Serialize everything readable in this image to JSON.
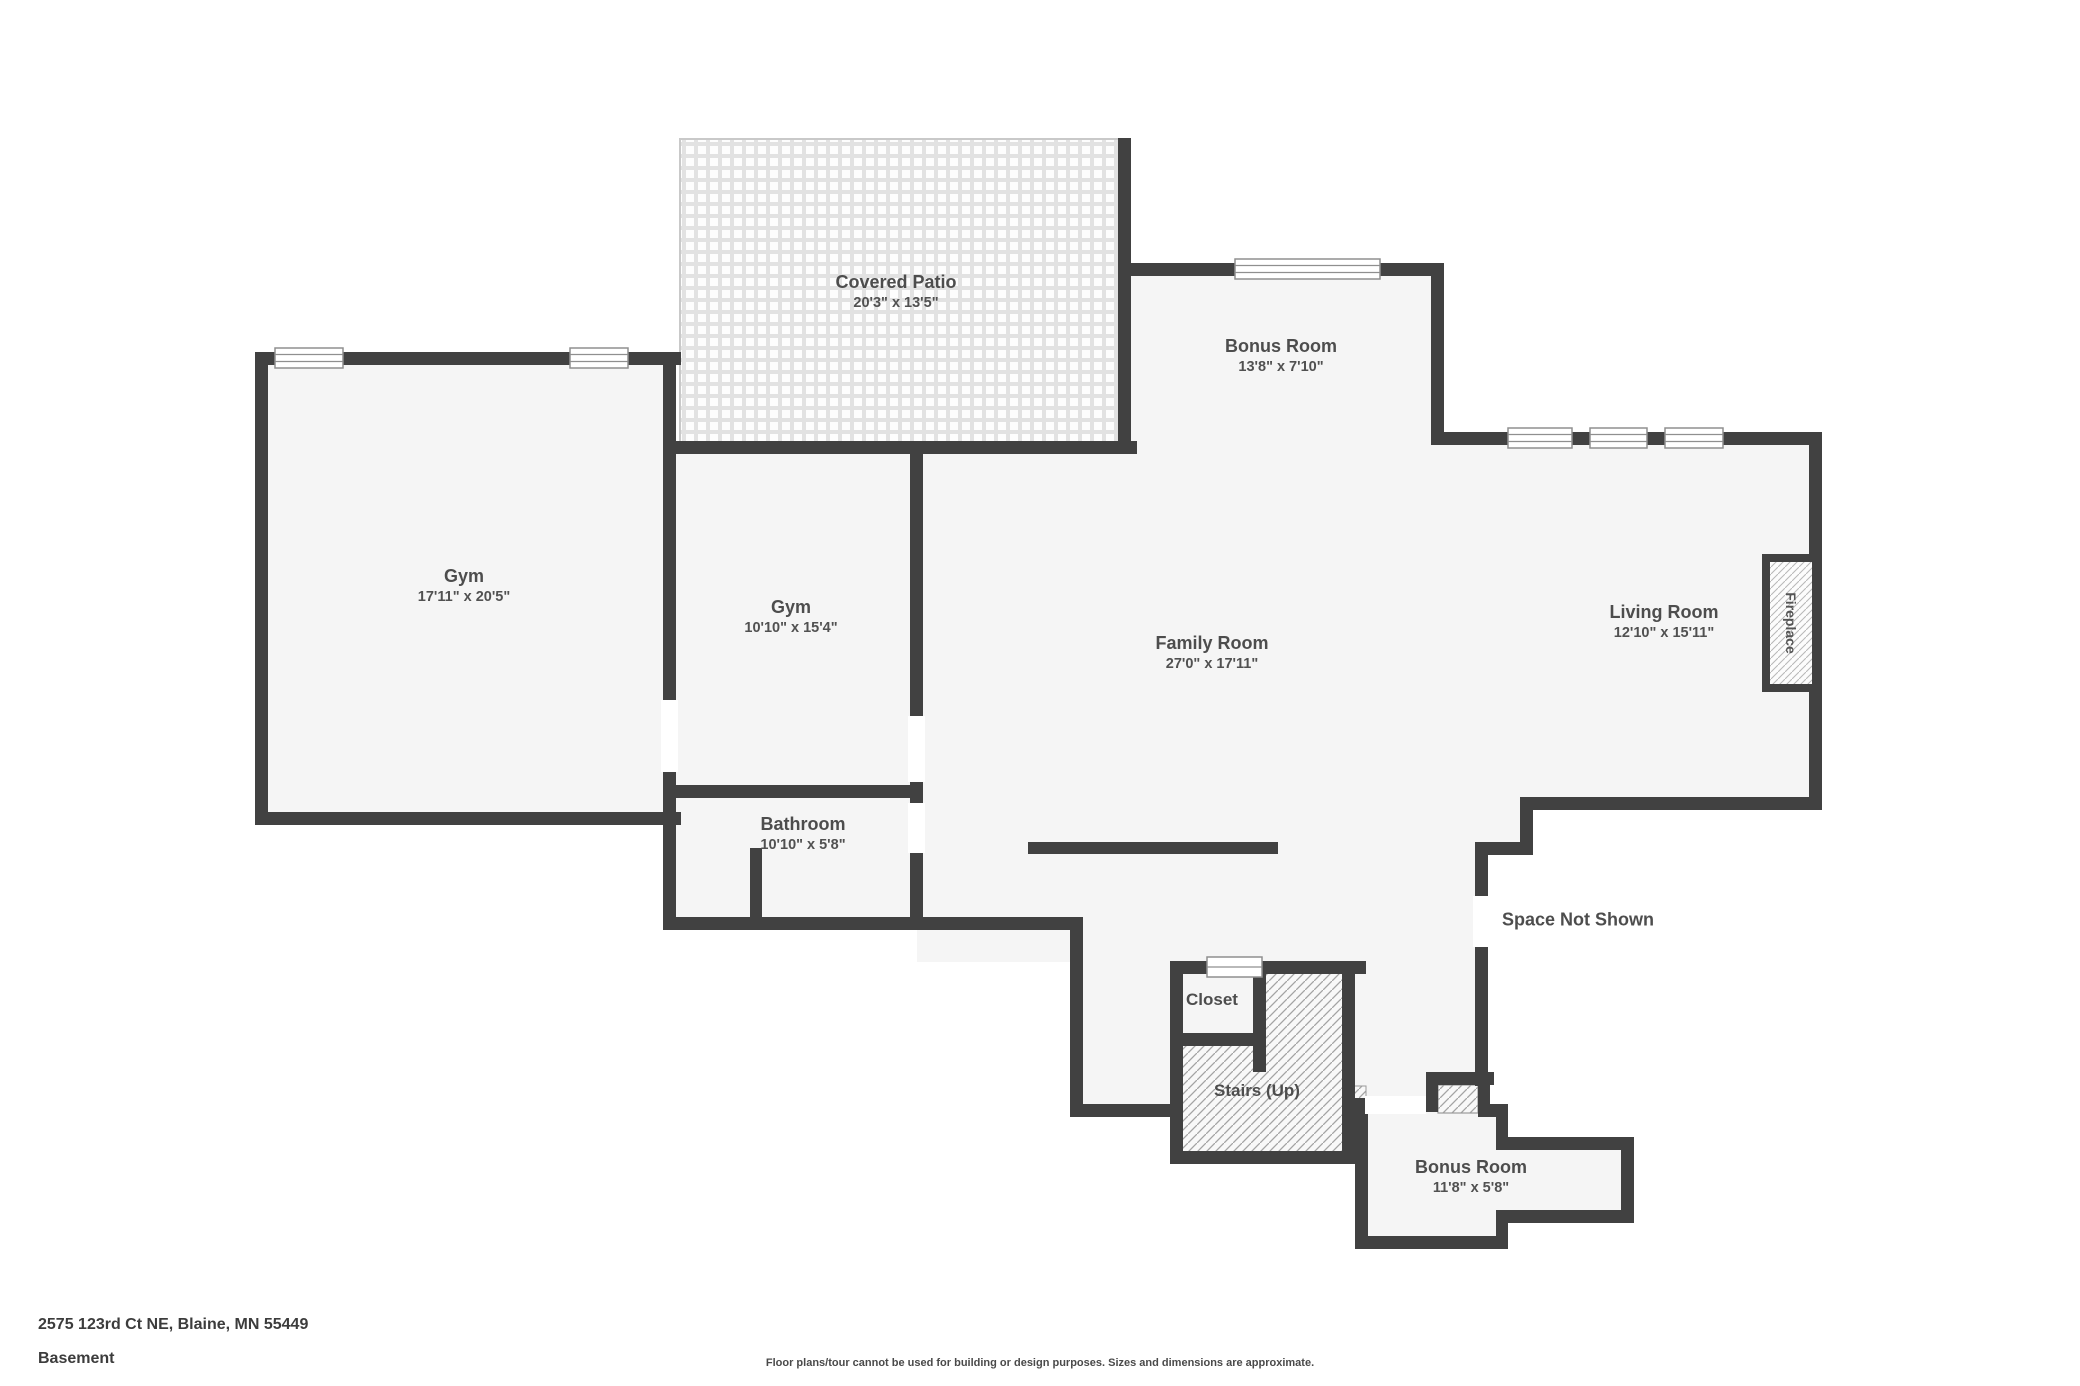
{
  "header": {
    "address": "2575 123rd Ct NE, Blaine, MN 55449",
    "floor_name": "Basement"
  },
  "footer": {
    "disclaimer": "Floor plans/tour cannot be used for building or design purposes. Sizes and dimensions are approximate."
  },
  "rooms": {
    "covered_patio": {
      "name": "Covered Patio",
      "dims": "20'3\" x 13'5\""
    },
    "bonus_room_top": {
      "name": "Bonus Room",
      "dims": "13'8\" x 7'10\""
    },
    "gym_large": {
      "name": "Gym",
      "dims": "17'11\" x 20'5\""
    },
    "gym_small": {
      "name": "Gym",
      "dims": "10'10\" x 15'4\""
    },
    "family_room": {
      "name": "Family Room",
      "dims": "27'0\" x 17'11\""
    },
    "living_room": {
      "name": "Living Room",
      "dims": "12'10\" x 15'11\""
    },
    "bathroom": {
      "name": "Bathroom",
      "dims": "10'10\" x 5'8\""
    },
    "closet": {
      "name": "Closet"
    },
    "stairs": {
      "name": "Stairs (Up)"
    },
    "bonus_room_bottom": {
      "name": "Bonus Room",
      "dims": "11'8\" x 5'8\""
    },
    "space_not_shown": {
      "name": "Space Not Shown"
    },
    "fireplace": {
      "name": "Fireplace"
    }
  },
  "colors": {
    "wall": "#414141",
    "floor": "#f5f5f5",
    "label_text": "#4d4d4d",
    "stairs_hatch": "#a3a3a3",
    "patio_grout": "#e2e2e2"
  }
}
